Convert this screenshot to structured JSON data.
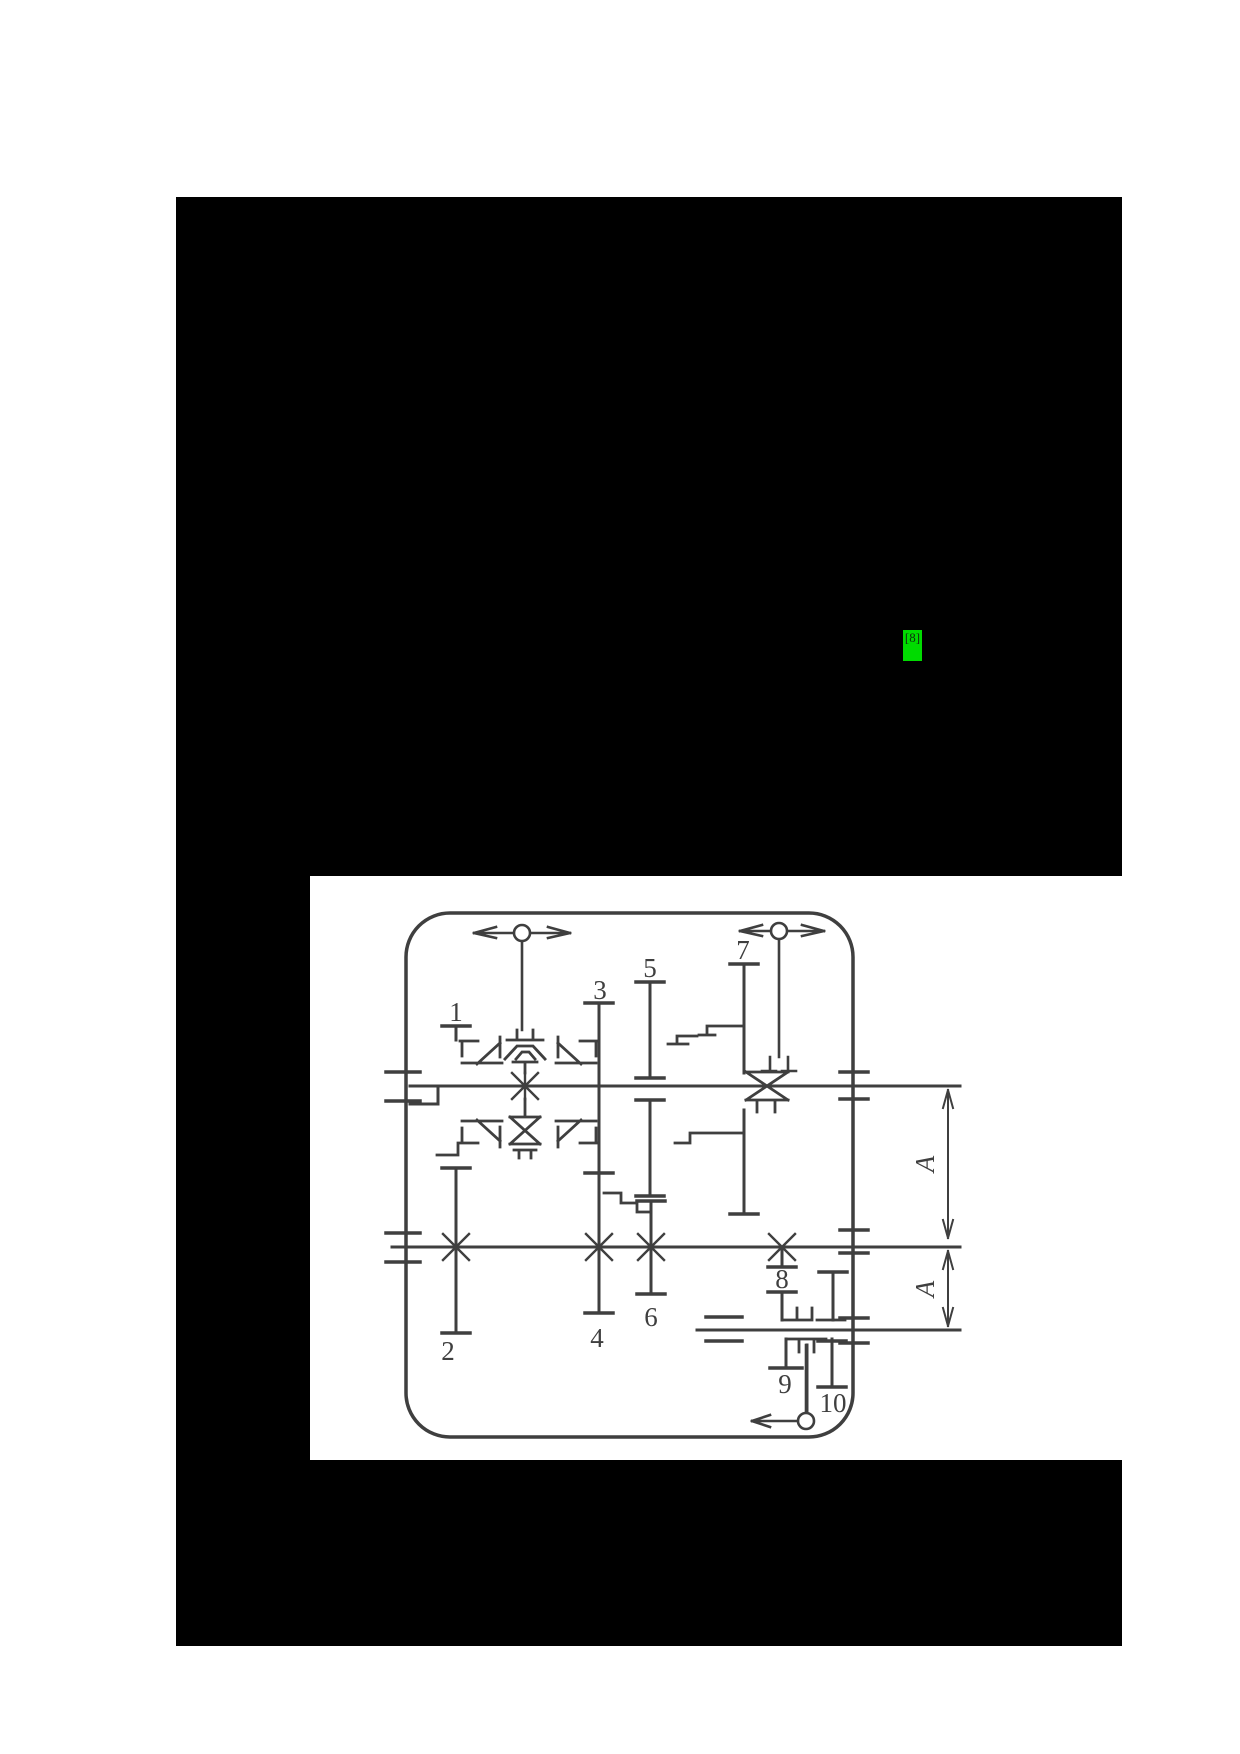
{
  "document": {
    "background": "#ffffff",
    "redaction_color": "#000000"
  },
  "citation_highlight": {
    "label": "[8]",
    "background": "#00db00",
    "text_color": "#0e2e0e"
  },
  "diagram": {
    "ink_color": "#3f3f3f",
    "paper_color": "#ffffff",
    "gear_labels": [
      {
        "id": "gear-1",
        "text": "1"
      },
      {
        "id": "gear-3",
        "text": "3"
      },
      {
        "id": "gear-5",
        "text": "5"
      },
      {
        "id": "gear-7",
        "text": "7"
      },
      {
        "id": "gear-2",
        "text": "2"
      },
      {
        "id": "gear-4",
        "text": "4"
      },
      {
        "id": "gear-6",
        "text": "6"
      },
      {
        "id": "gear-8",
        "text": "8"
      },
      {
        "id": "gear-9",
        "text": "9"
      },
      {
        "id": "gear-10",
        "text": "10"
      }
    ],
    "dimension_labels": [
      {
        "id": "center-distance-upper",
        "text": "A"
      },
      {
        "id": "center-distance-lower",
        "text": "A"
      }
    ]
  }
}
